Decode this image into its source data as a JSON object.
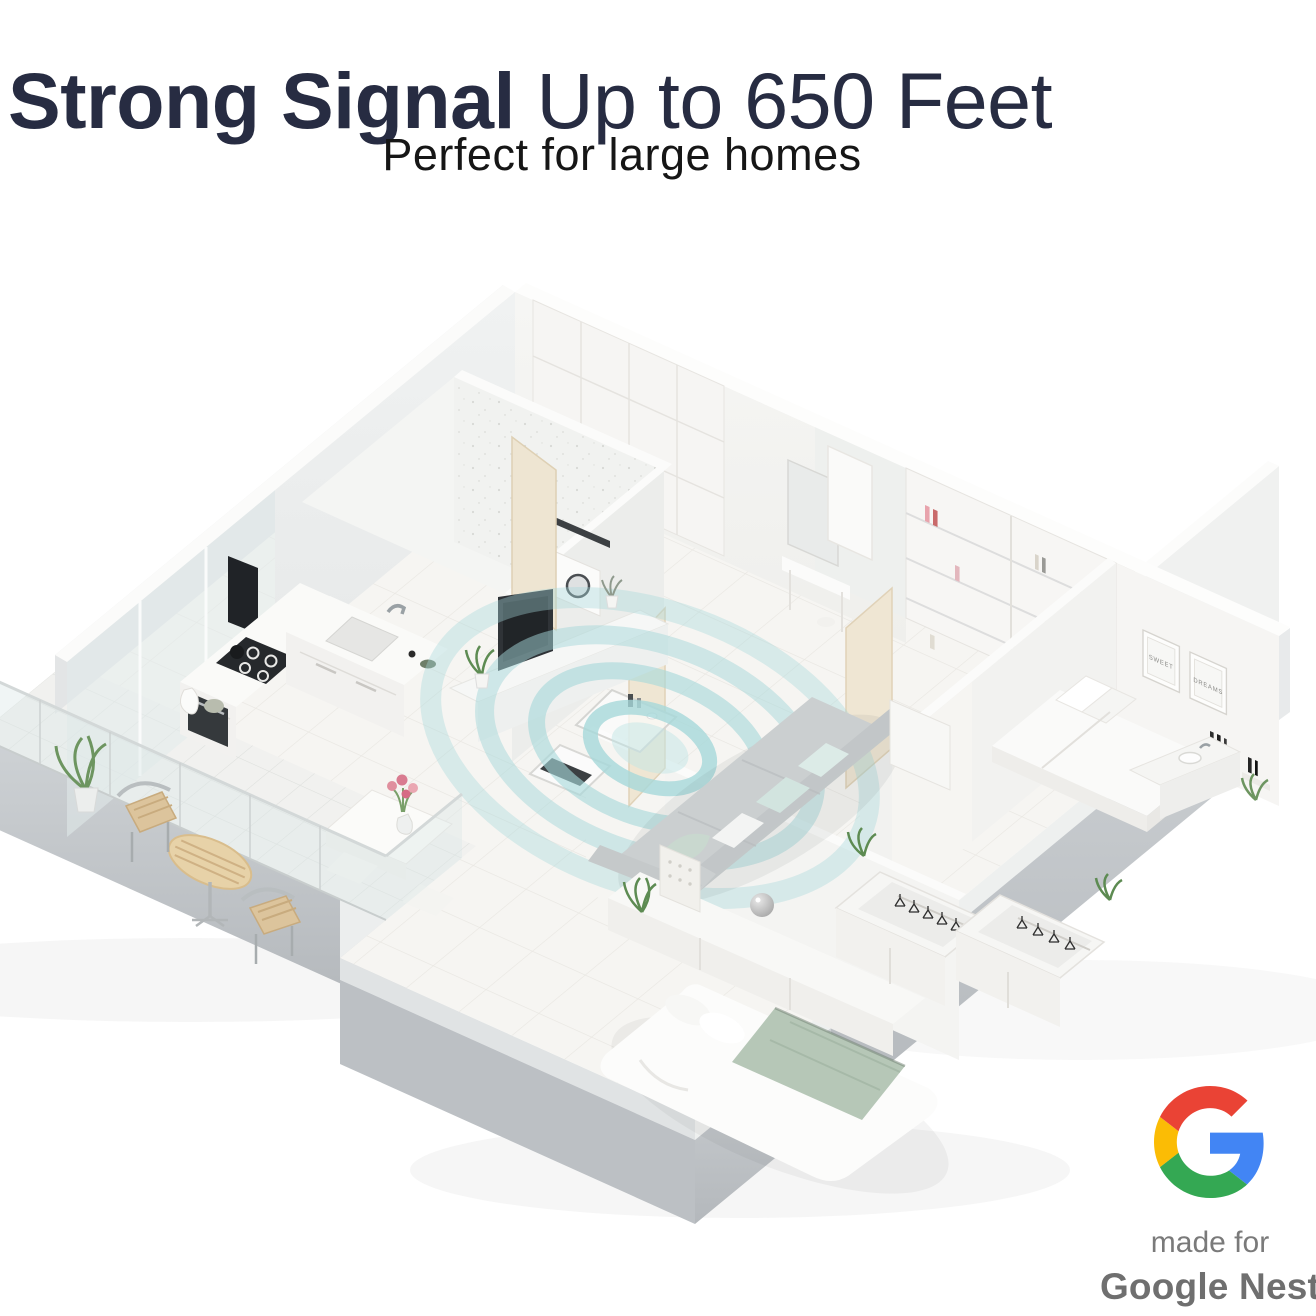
{
  "header": {
    "title_strong": "Strong Signal",
    "title_light": " Up to 650 Feet",
    "subtitle": "Perfect for large homes",
    "title_color": "#272c42"
  },
  "floorplan": {
    "signal_color": "#a6d8da",
    "signal_glow": "#c2e5e5",
    "frames": {
      "frame1": "SWEET",
      "frame2": "DREAMS"
    }
  },
  "badge": {
    "made_for": "made for",
    "brand": "Google Nest",
    "text_color": "#757575",
    "logo_colors": {
      "blue": "#4285F4",
      "green": "#34A853",
      "yellow": "#FBBC05",
      "red": "#EA4335"
    }
  }
}
